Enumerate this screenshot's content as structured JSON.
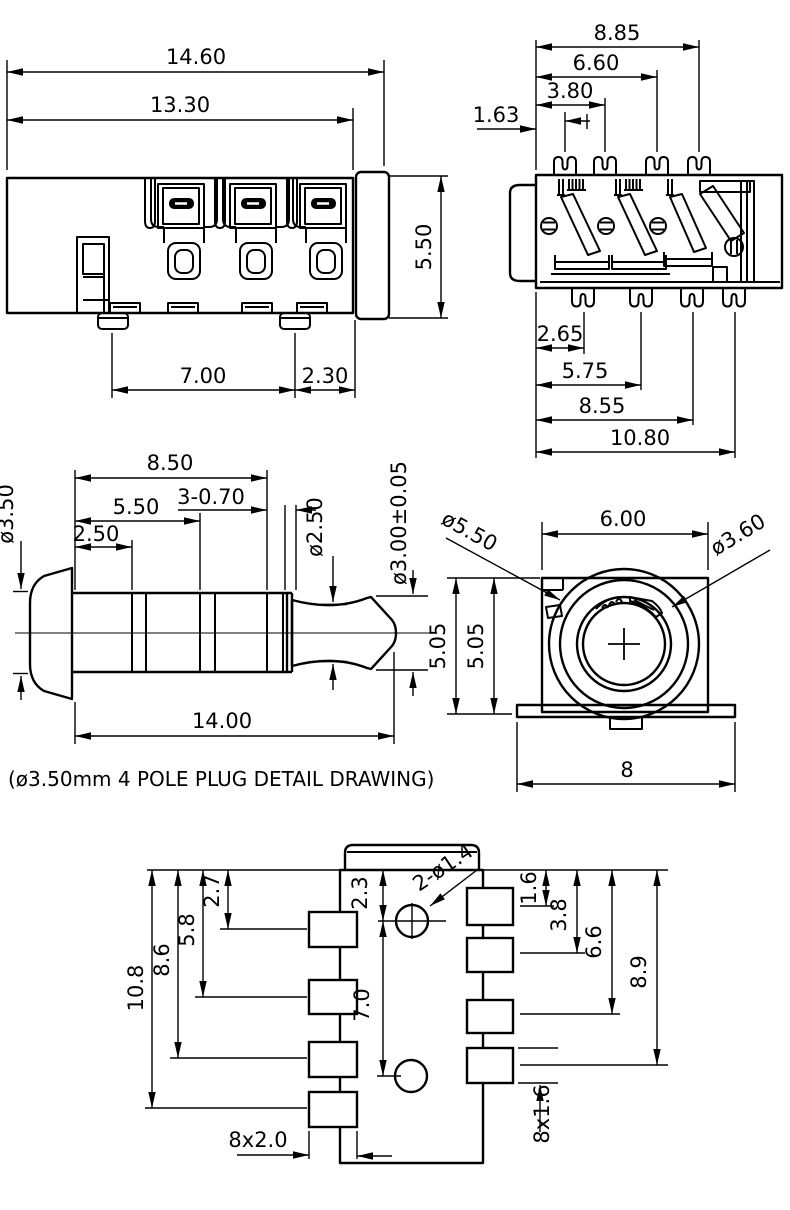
{
  "drawing": {
    "caption": "(ø3.50mm  4  POLE  PLUG  DETAIL  DRAWING)",
    "colors": {
      "ink": "#000000",
      "paper": "#ffffff"
    },
    "views": {
      "jack_side": {
        "dims": {
          "overall_width": "14.60",
          "body_width": "13.30",
          "height": "5.50",
          "pad_pitch": "7.00",
          "pad_edge": "2.30"
        }
      },
      "jack_contacts": {
        "dims": {
          "pin4": "8.85",
          "pin3": "6.60",
          "pin2": "3.80",
          "pin1": "1.63",
          "lower_pin1": "2.65",
          "lower_pin2": "5.75",
          "lower_pin3": "8.55",
          "lower_pin4": "10.80"
        }
      },
      "plug_detail": {
        "dims": {
          "sleeve_length": "8.50",
          "grooves": "3-0.70",
          "ring2": "5.50",
          "ring1": "2.50",
          "sleeve_dia": "ø3.50",
          "neck_dia": "ø2.50",
          "tip_dia": "ø3.00±0.05",
          "total_length": "14.00"
        }
      },
      "jack_front": {
        "dims": {
          "bezel_dia": "ø5.50",
          "body_width": "6.00",
          "hole_dia": "ø3.60",
          "height_a": "5.05",
          "height_b": "5.05",
          "flange_width": "8"
        }
      },
      "footprint": {
        "dims": {
          "pad_l1": "2.7",
          "pad_l2": "5.8",
          "pad_l3": "8.6",
          "pad_l4": "10.8",
          "hole_offset": "2.3",
          "hole_pitch": "7.0",
          "hole_note": "2-ø1.4",
          "pad_r1": "1.6",
          "pad_r2": "3.8",
          "pad_r3": "6.6",
          "pad_r4": "8.9",
          "pad_width_note": "8x2.0",
          "pad_height_note": "8x1.6"
        }
      }
    }
  }
}
